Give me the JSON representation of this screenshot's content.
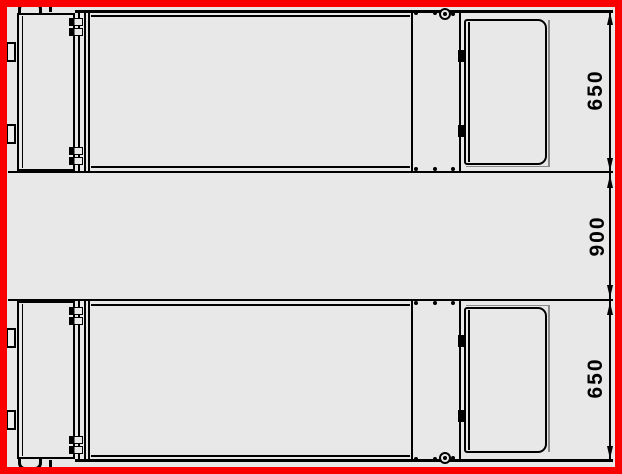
{
  "drawing": {
    "dimension_labels": {
      "top_unit": "650",
      "gap": "900",
      "bottom_unit": "650"
    },
    "colors": {
      "frame_red": "#fb0000",
      "background_gray": "#e8e8e8",
      "line_black": "#000000"
    }
  }
}
